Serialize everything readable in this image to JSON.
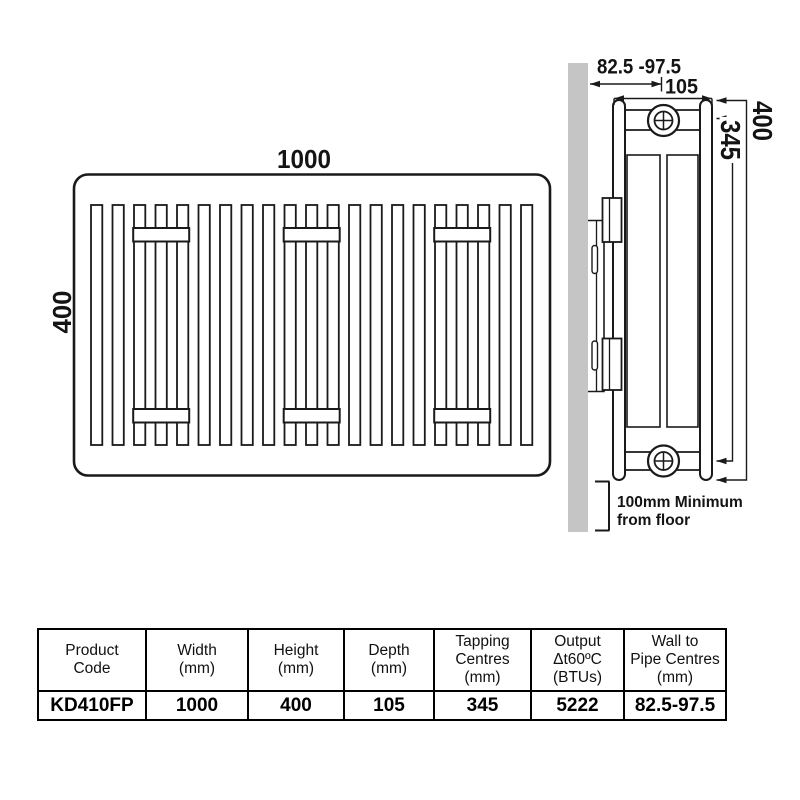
{
  "diagram": {
    "front_view": {
      "width_label": "1000",
      "height_label": "400"
    },
    "side_view": {
      "wall_to_pipe_centres_label": "82.5 -97.5",
      "depth_label": "105",
      "height_label": "400",
      "tapping_centres_label": "345",
      "floor_clearance_note": [
        "100mm Minimum",
        "from floor"
      ]
    },
    "colors": {
      "wall_fill": "#c5c5c5",
      "line": "#1a1a1a"
    }
  },
  "spec_table": {
    "headers": [
      {
        "lines": [
          "Product",
          "Code",
          ""
        ]
      },
      {
        "lines": [
          "Width",
          "(mm)",
          ""
        ]
      },
      {
        "lines": [
          "Height",
          "(mm)",
          ""
        ]
      },
      {
        "lines": [
          "Depth",
          "(mm)",
          ""
        ]
      },
      {
        "lines": [
          "Tapping",
          "Centres",
          "(mm)"
        ]
      },
      {
        "lines": [
          "Output",
          "Δt60ºC",
          "(BTUs)"
        ]
      },
      {
        "lines": [
          "Wall to",
          "Pipe Centres",
          "(mm)"
        ]
      }
    ],
    "row": {
      "product_code": "KD410FP",
      "width_mm": "1000",
      "height_mm": "400",
      "depth_mm": "105",
      "tapping_centres_mm": "345",
      "output_btus": "5222",
      "wall_to_pipe_centres_mm": "82.5-97.5"
    }
  }
}
